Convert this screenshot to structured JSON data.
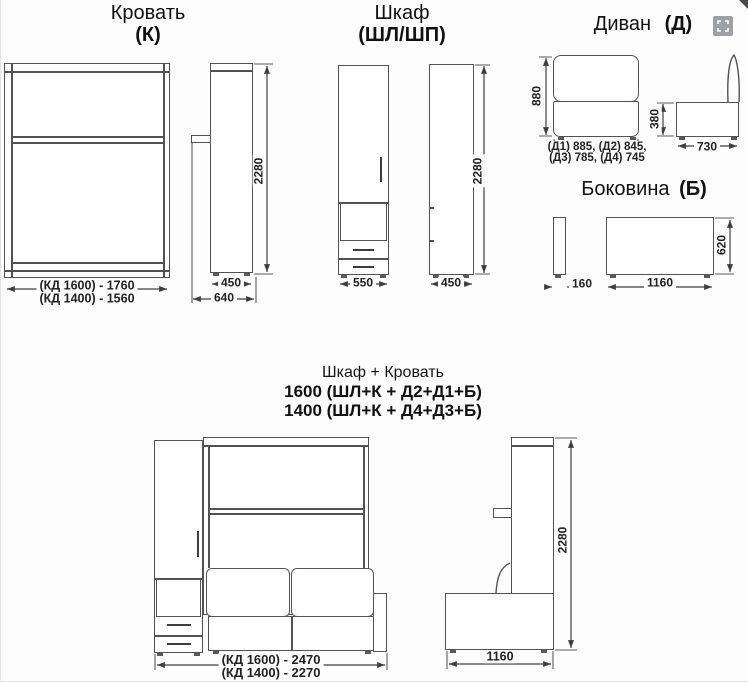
{
  "colors": {
    "line": "#525252",
    "text": "#222222",
    "icon_bg": "#9ba1a6"
  },
  "bed": {
    "title": "Кровать",
    "code": "(К)",
    "front_dim_line1": "(КД 1600) - 1760",
    "front_dim_line2": "(КД 1400) - 1560",
    "side_height": "2280",
    "side_depth_inner": "450",
    "side_depth_outer": "640"
  },
  "wardrobe": {
    "title": "Шкаф",
    "code": "(ШЛ/ШП)",
    "front_width": "550",
    "side_depth": "450",
    "side_height": "2280"
  },
  "sofa": {
    "title": "Диван",
    "code": "(Д)",
    "front_height": "880",
    "front_widths_line1": "(Д1) 885, (Д2) 845,",
    "front_widths_line2": "(Д3) 785, (Д4) 745",
    "side_seat_height": "380",
    "side_depth": "730"
  },
  "side_panel": {
    "title": "Боковина",
    "code": "(Б)",
    "thickness": "160",
    "length": "1160",
    "height": "620"
  },
  "combo": {
    "title": "Шкаф + Кровать",
    "variant_1600": "1600 (ШЛ+К + Д2+Д1+Б)",
    "variant_1400": "1400 (ШЛ+К + Д4+Д3+Б)",
    "front_dim_line1": "(КД 1600) - 2470",
    "front_dim_line2": "(КД 1400) - 2270",
    "side_height": "2280",
    "side_depth": "1160"
  }
}
